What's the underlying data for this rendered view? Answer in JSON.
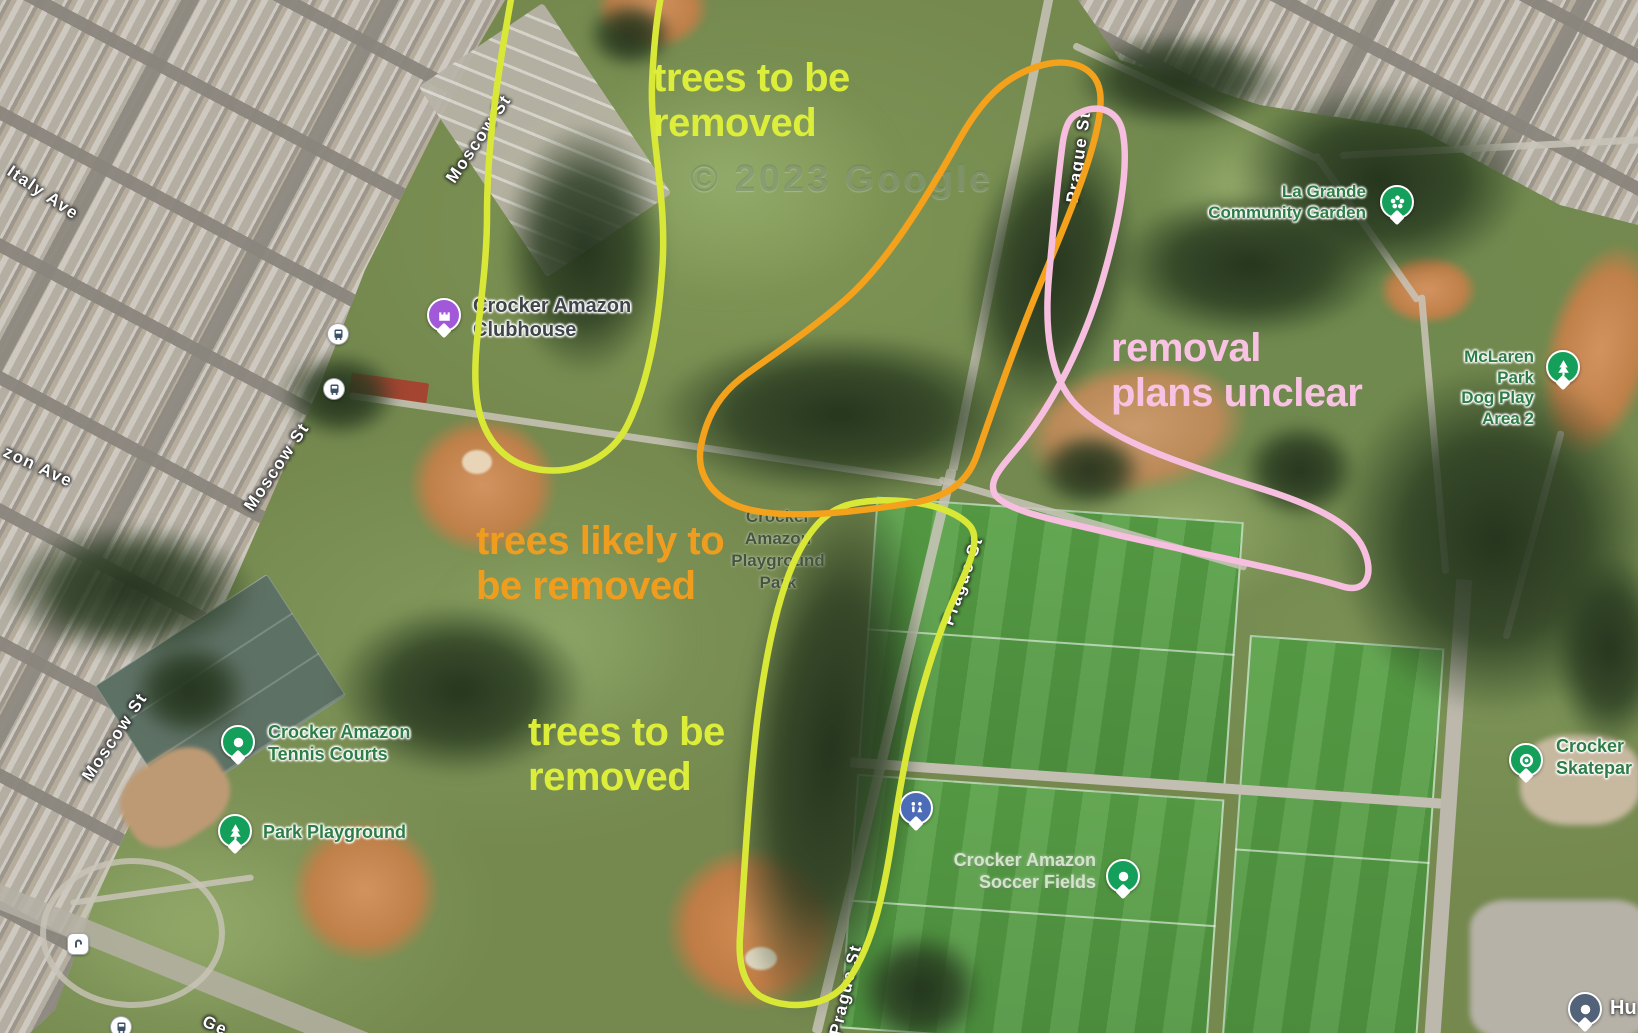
{
  "watermark": "© 2023 Google",
  "streets": {
    "italy_ave": "Italy Ave",
    "moscow_st": "Moscow St",
    "zon_ave": "zon Ave",
    "prague_st": "Prague St",
    "geneva_partial": "Ge"
  },
  "pois": {
    "clubhouse": "Crocker Amazon\nClubhouse",
    "community_garden": "La Grande\nCommunity Garden",
    "dog_play_area": "McLaren Park\nDog Play Area 2",
    "tennis_courts": "Crocker Amazon\nTennis Courts",
    "park_playground": "Park Playground",
    "park_name": "Crocker\nAmazon\nPlayground\nPark",
    "soccer_fields": "Crocker Amazon\nSoccer Fields",
    "skatepark": "Crocker\nSkatepar",
    "hu_partial": "Hu"
  },
  "annotations": {
    "trees_removed_top": "trees to be\nremoved",
    "trees_likely": "trees likely to\nbe removed",
    "trees_removed_bottom": "trees to be\nremoved",
    "removal_unclear": "removal\nplans unclear",
    "colors": {
      "remove_text": "#dcee3a",
      "likely_text": "#ef9d1e",
      "unclear_text": "#f8c3e2",
      "loop_yellow": "#d9e837",
      "loop_orange": "#f4a11c",
      "loop_pink": "#f6bedf"
    }
  }
}
